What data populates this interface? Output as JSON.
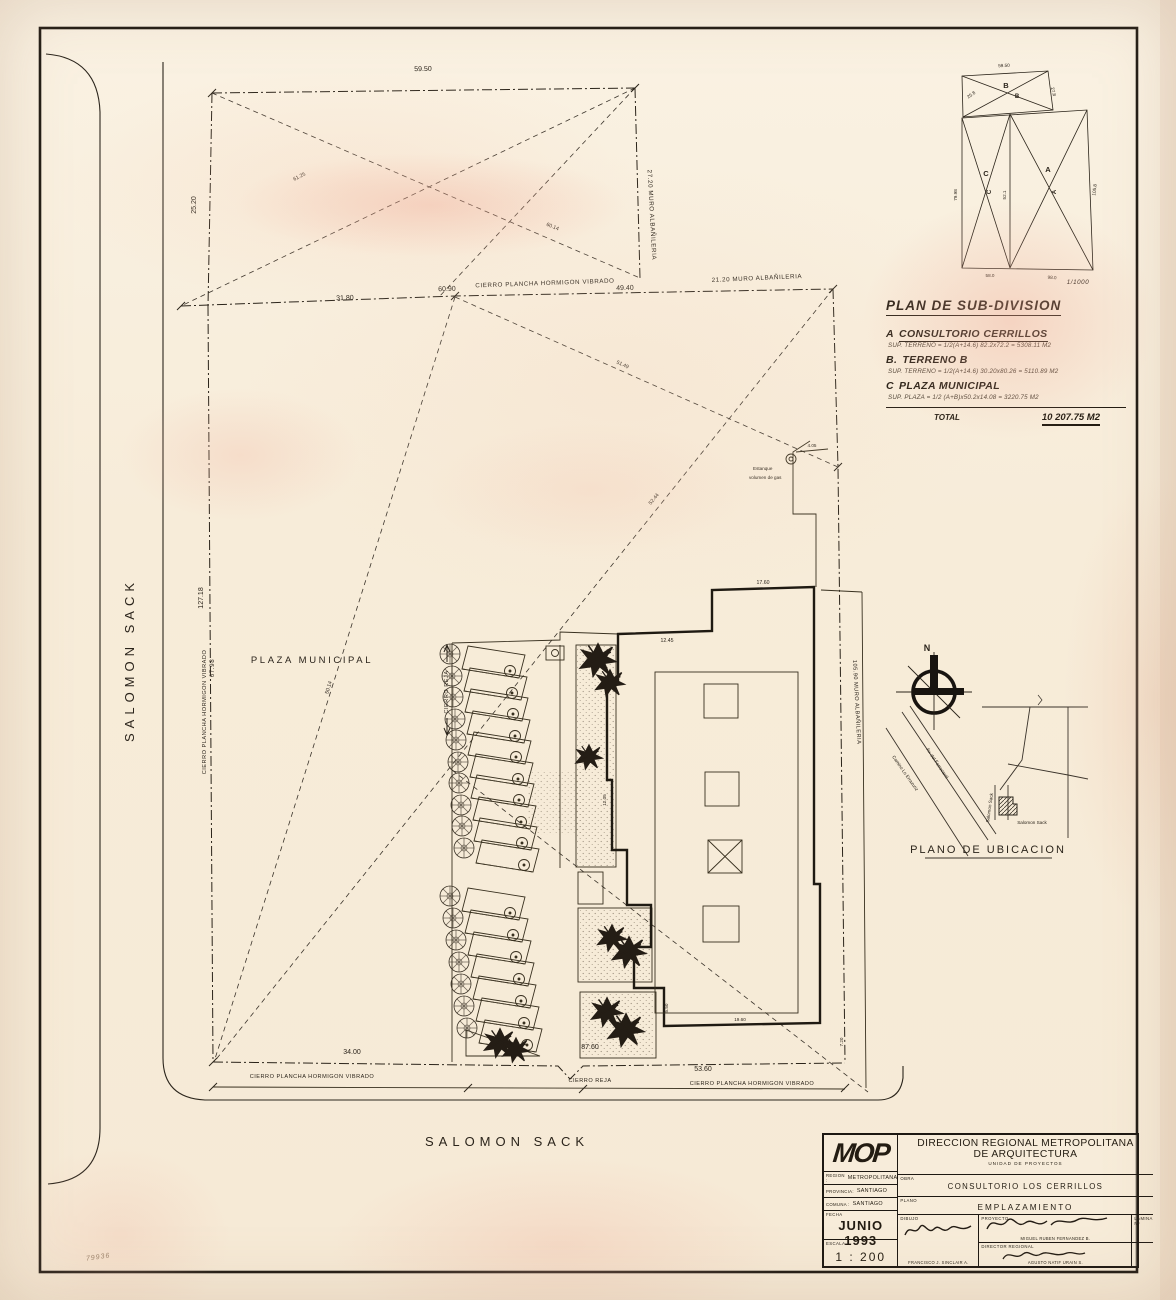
{
  "plan": {
    "street_left": "SALOMON SACK",
    "street_bottom": "SALOMON SACK",
    "plaza": "PLAZA MUNICIPAL",
    "tank_1": "Estanque",
    "tank_2": "volumen de gas",
    "fence_top": "CIERRO PLANCHA HORMIGON VIBRADO",
    "fence_left": "CIERRO PLANCHA HORMIGON VIBRADO",
    "fence_bottom_a": "CIERRO PLANCHA HORMIGON VIBRADO",
    "fence_bottom_b": "CIERRO PLANCHA HORMIGON VIBRADO",
    "gate_bottom": "CIERRO REJA",
    "gate_inner": "CIERRO REJA",
    "dims": {
      "top": "59.50",
      "top_left": "25.20",
      "wall_parcel": "27.20  MURO ALBAÑILERIA",
      "row2_a": "31.80",
      "row2_b": "60.90",
      "row2_c": "49.40",
      "wall_top": "21.20  MURO ALBAÑILERIA",
      "west": "127.18",
      "west_len": "67.98",
      "east_wall": "105.90  MURO ALBAÑILERIA",
      "diag_t1": "61.25",
      "diag_t2": "60.14",
      "diag_1": "51.49",
      "diag_2": "52.44",
      "diag_3": "50.14",
      "bot_a": "34.00",
      "bot_b": "87.60",
      "bot_c": "53.60",
      "bld_top": "17.60",
      "bld_ledge": "12.45",
      "bld_left": "12.05",
      "bld_bot": "19.60",
      "r_a": "7.20",
      "r_b": "5.50",
      "tank": "4.05"
    }
  },
  "subdiv": {
    "b": "B",
    "c": "C",
    "a": "A",
    "scale_note": "1/1000",
    "d_top": "59.50",
    "d_left": "79.98",
    "d_right": "105.8",
    "d_mid": "52.1",
    "d_bot_a": "58.0",
    "d_bot_b": "98.0",
    "d_ul": "25.8",
    "d_ur": "27.8"
  },
  "legend": {
    "title": "PLAN DE SUB-DIVISION",
    "items": [
      {
        "key": "A",
        "name": "CONSULTORIO CERRILLOS",
        "detail": "SUP. TERRENO = 1/2(A+14.6) 82.2x72.2 = 5308.11 M2"
      },
      {
        "key": "B.",
        "name": "TERRENO B",
        "detail": "SUP. TERRENO = 1/2(A+14.6) 30.20x80.26 = 5110.89 M2"
      },
      {
        "key": "C",
        "name": "PLAZA MUNICIPAL",
        "detail": "SUP. PLAZA = 1/2 (A+B)x50.2x14.08 = 3220.75 M2"
      }
    ],
    "total_label": "TOTAL",
    "total_value": "10 207.75 M2"
  },
  "location_map": {
    "title": "PLANO DE UBICACION",
    "north": "N",
    "s_camino": "Camino Lo Errazuriz",
    "s_ferro": "Av. del Ferrocarril",
    "s_sack_v": "Salomon Sack",
    "s_sack_h": "Salomon Sack"
  },
  "titleblock": {
    "logo": "MOP",
    "org_1": "DIRECCION REGIONAL METROPOLITANA",
    "org_2": "DE ARQUITECTURA",
    "org_3": "UNIDAD DE PROYECTOS",
    "region_label": "REGION :",
    "region": "METROPOLITANA",
    "provincia_label": "PROVINCIA:",
    "provincia": "SANTIAGO",
    "comuna_label": "COMUNA :",
    "comuna": "SANTIAGO",
    "obra_label": "OBRA",
    "obra": "CONSULTORIO  LOS  CERRILLOS",
    "plano_label": "PLANO",
    "plano": "EMPLAZAMIENTO",
    "fecha_label": "FECHA",
    "fecha": "JUNIO 1993",
    "escala_label": "ESCALA",
    "escala": "1 : 200",
    "dibujo_label": "DIBUJO",
    "dibujo": "FRANCISCO J. SINCLAIR A.",
    "proyecto_label": "PROYECTO",
    "proyecto": "MIGUEL RUBEN FERNANDEZ B.",
    "director_label": "DIRECTOR REGIONAL",
    "director": "AGUSTO NATIF URAIN S.",
    "lamina_label": "LAMINA Nº"
  },
  "margin_note": "79936"
}
